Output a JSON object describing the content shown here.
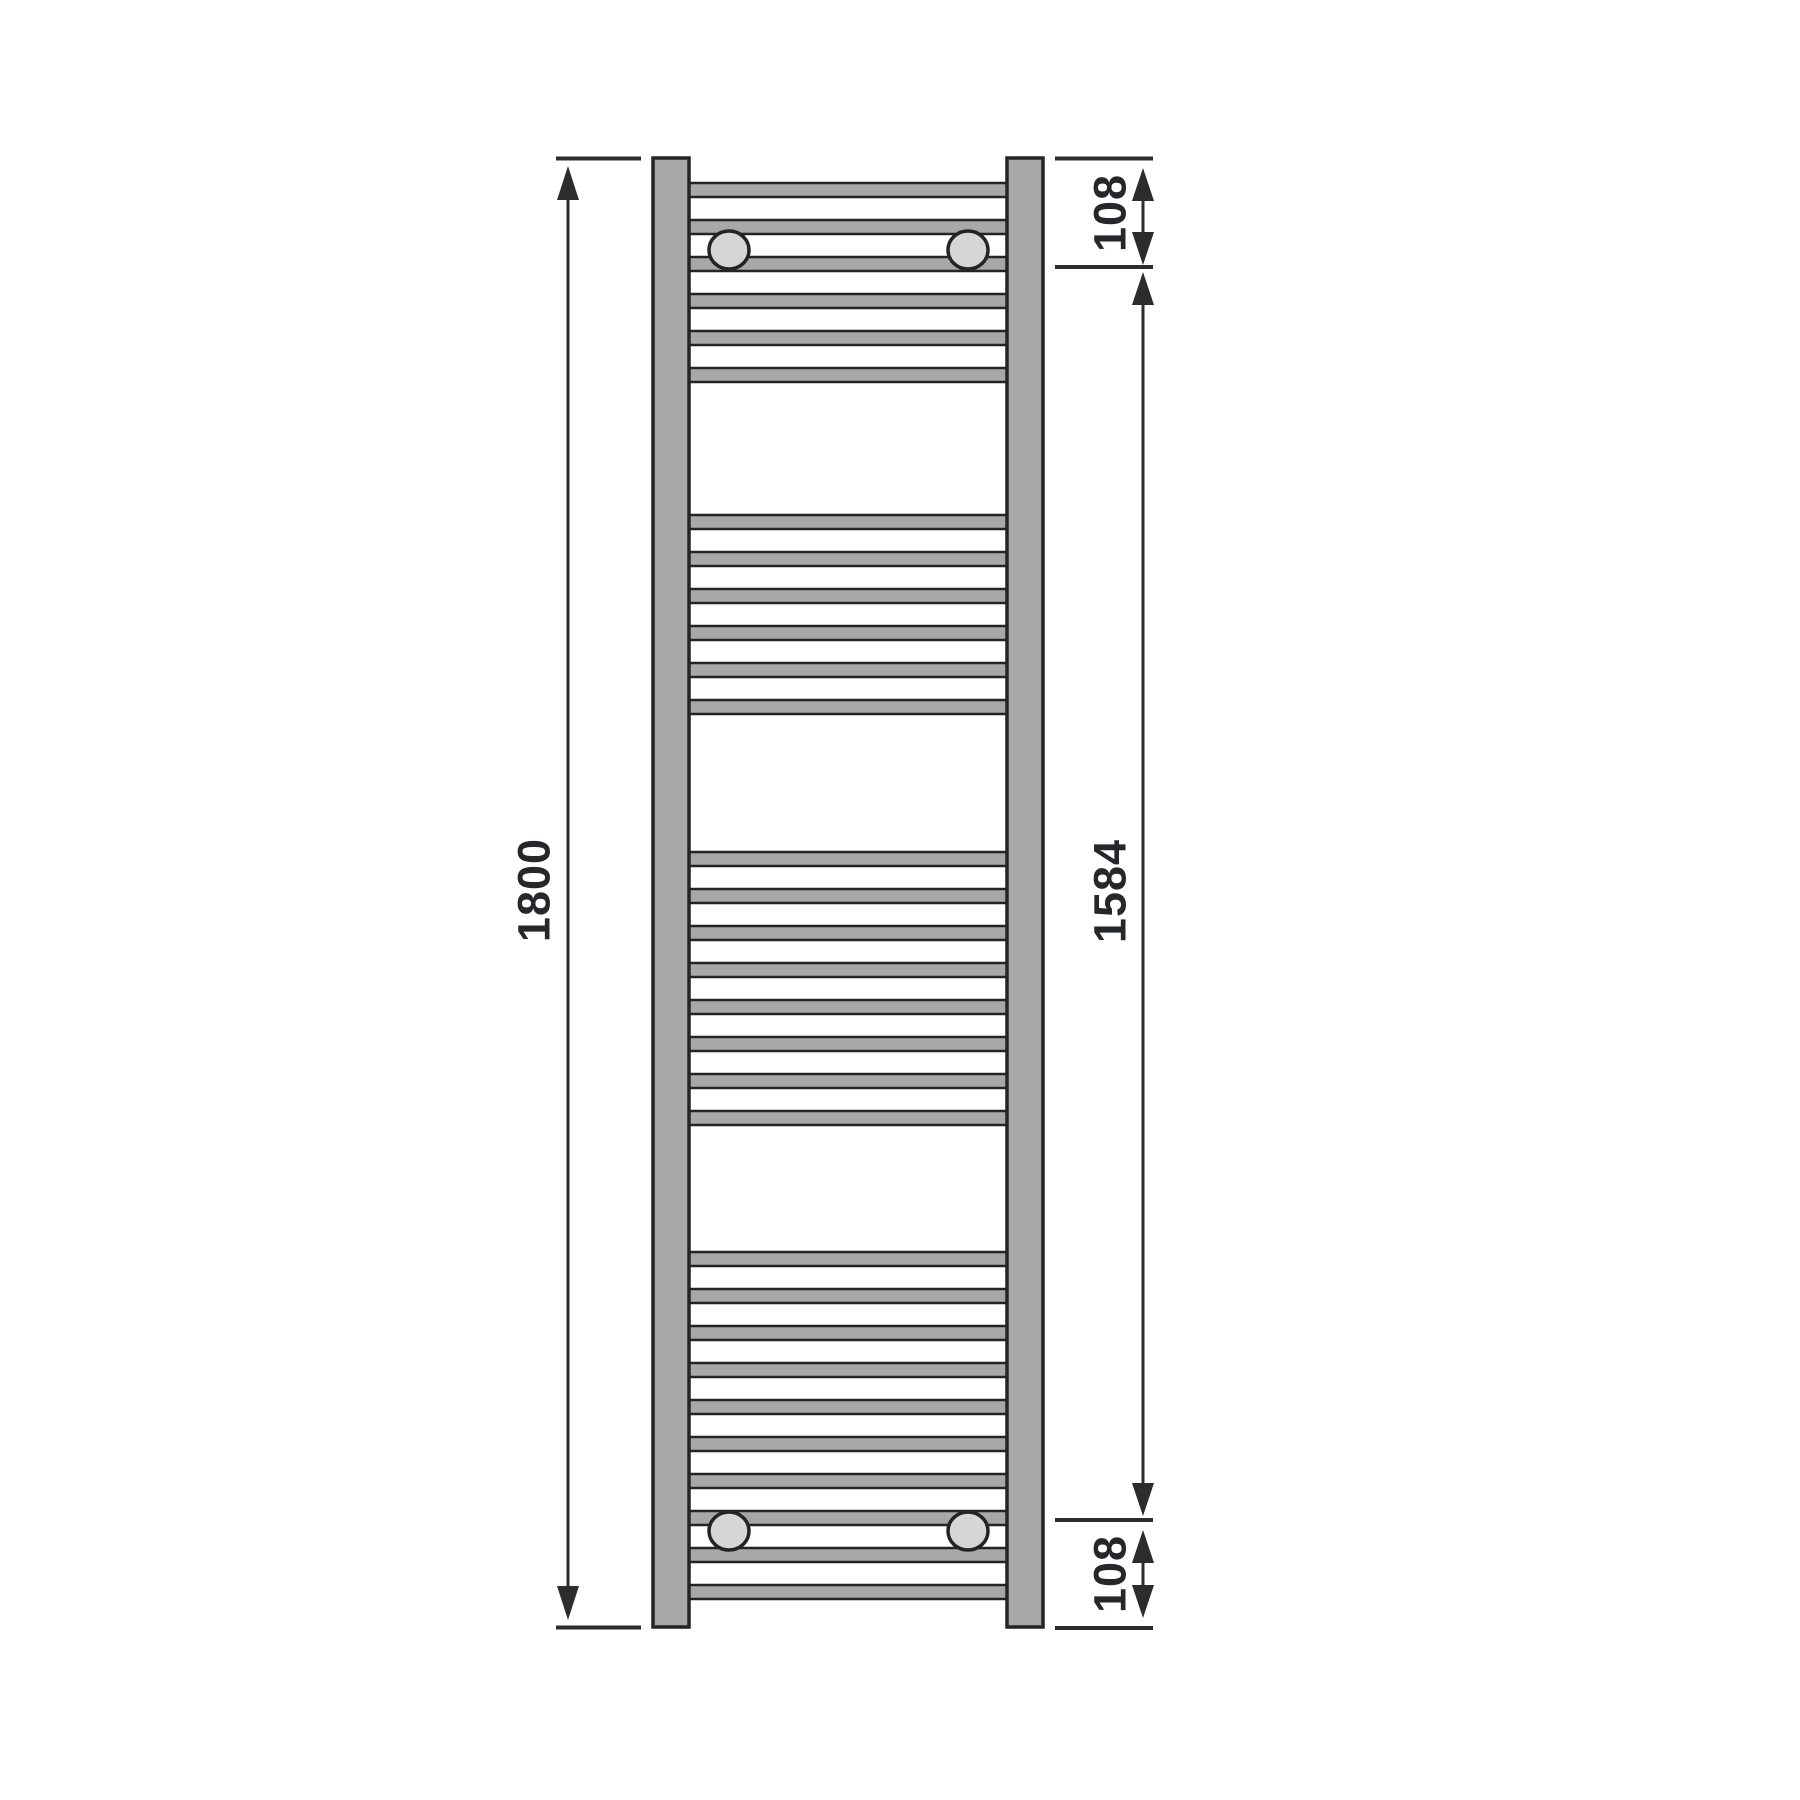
{
  "diagram": {
    "kind": "technical-dimension-drawing",
    "subject": "ladder towel radiator, front elevation with mounting dimensions",
    "dimensions": {
      "overall_height": "1800",
      "bracket_spacing": "1584",
      "top_offset": "108",
      "bottom_offset": "108"
    },
    "colors": {
      "bg": "#ffffff",
      "tube_fill": "#a8a8a8",
      "bracket_fill": "#d6d6d6",
      "outline": "#242424",
      "dim": "#2c2c2c",
      "dim_text": "#26272b"
    },
    "radiator": {
      "top": 158,
      "bottom": 1627,
      "rung_left": 683,
      "rung_right": 1013,
      "rung_height": 14,
      "rung_spacing": 37,
      "rung_groups": [
        {
          "start_y": 183,
          "count": 6
        },
        {
          "start_y": 515,
          "count": 6
        },
        {
          "start_y": 852,
          "count": 8
        },
        {
          "start_y": 1252,
          "count": 10
        }
      ],
      "brackets": {
        "cx_left": 729,
        "cx_right": 968,
        "cy_top": 250,
        "cy_bottom": 1531,
        "rx": 20,
        "ry": 19
      }
    }
  }
}
